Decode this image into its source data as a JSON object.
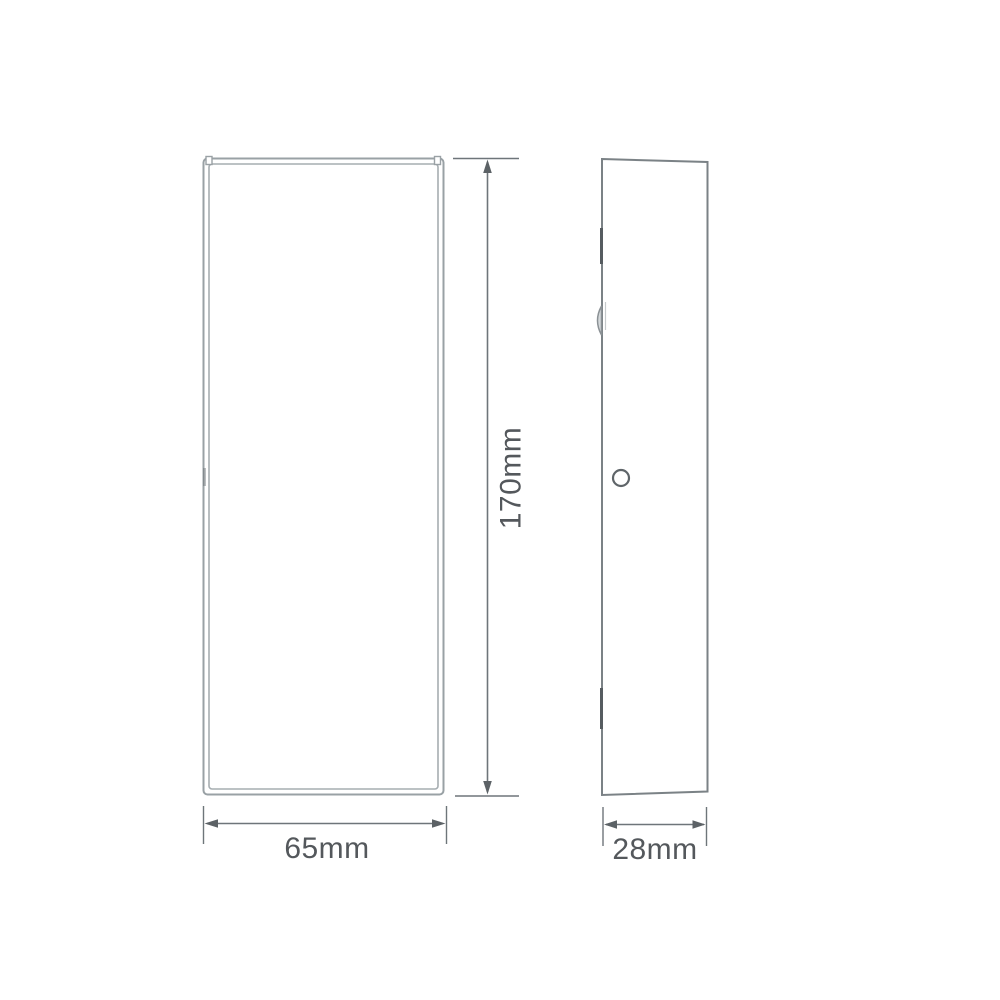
{
  "drawing": {
    "type": "product-dimension-diagram",
    "views": {
      "front": {
        "name": "front-view"
      },
      "side": {
        "name": "side-profile-view"
      }
    },
    "dimensions": {
      "height": {
        "label": "170mm",
        "applies_to": "front-view"
      },
      "width": {
        "label": "65mm",
        "applies_to": "front-view"
      },
      "depth": {
        "label": "28mm",
        "applies_to": "side-profile-view"
      }
    },
    "features": {
      "mounting_hole": {
        "name": "mounting-hole"
      }
    },
    "colors": {
      "background": "#ffffff",
      "front_outline": "#99a1a5",
      "side_outline": "#7b8286",
      "dimension_lines": "#6e757a",
      "label_text": "#54585c"
    }
  }
}
